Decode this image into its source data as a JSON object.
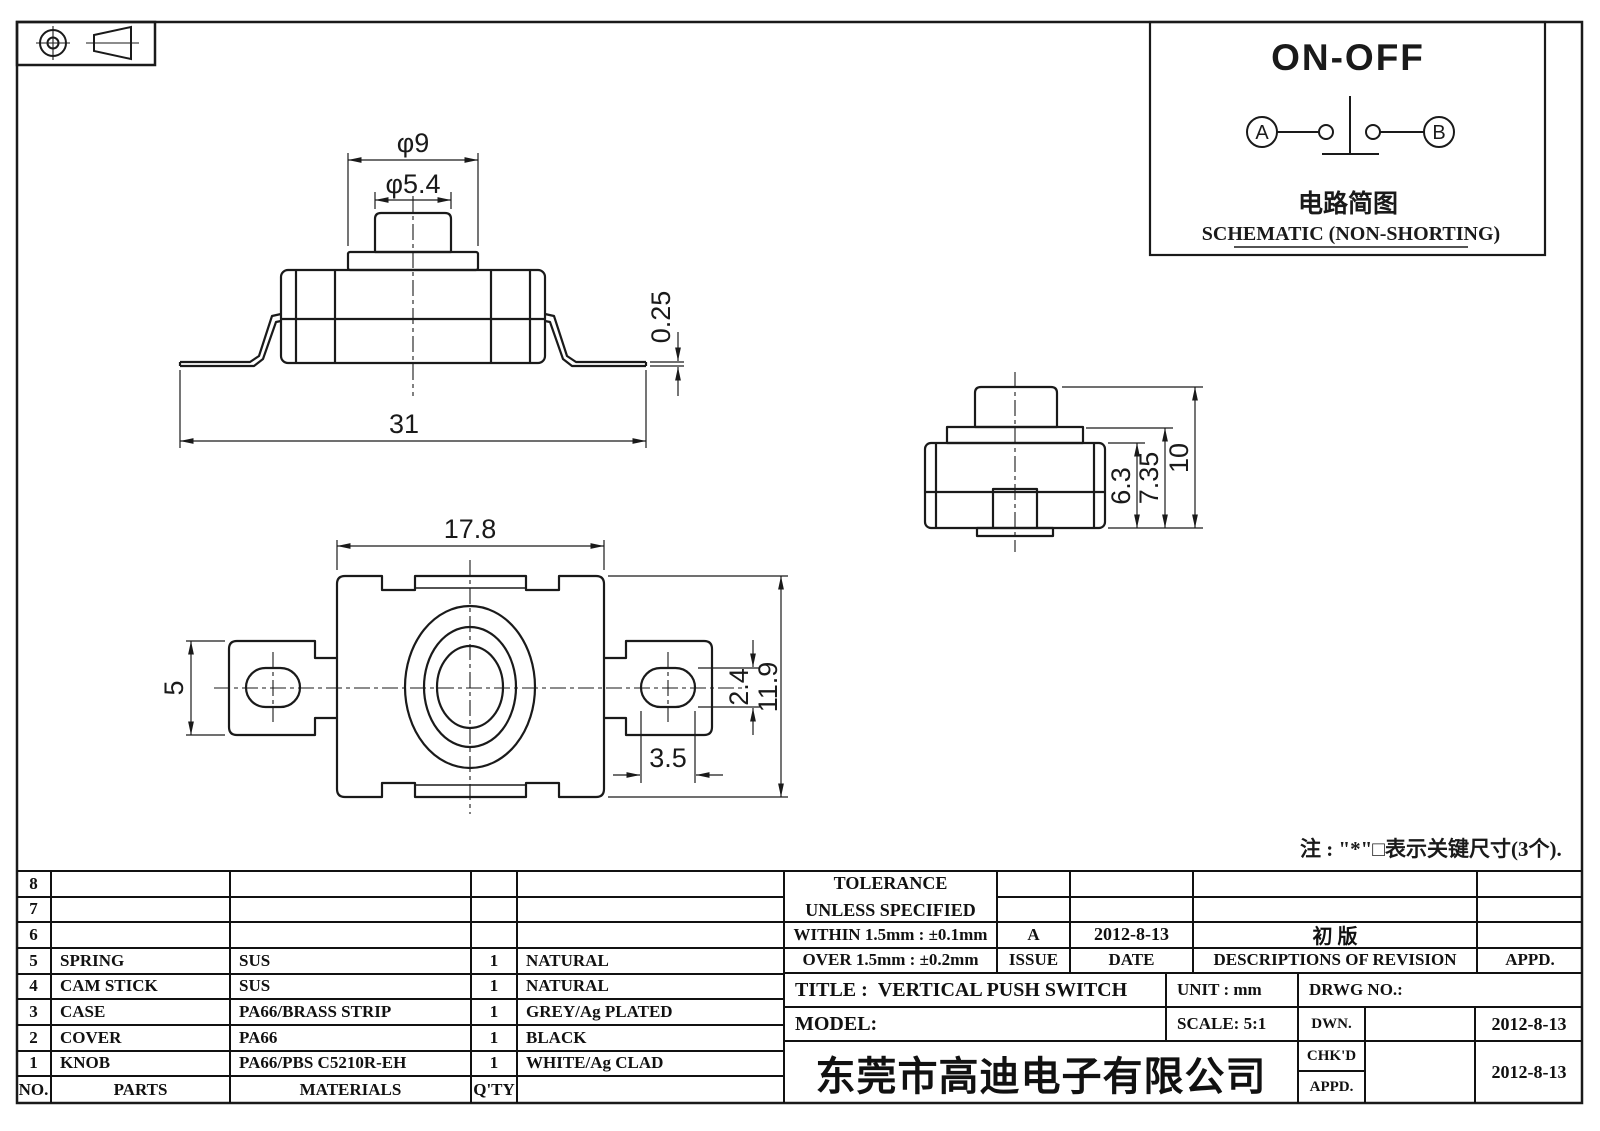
{
  "sheet": {
    "background": "#ffffff",
    "line_color": "#1a1a1a"
  },
  "schematic_panel": {
    "title": "ON-OFF",
    "terminal_a": "A",
    "terminal_b": "B",
    "caption_cn": "电路简图",
    "caption_en": "SCHEMATIC (NON-SHORTING)"
  },
  "note": "注 : \"*\"□表示关键尺寸(3个).",
  "front_view": {
    "dim_flange_dia": "φ9",
    "dim_knob_dia": "φ5.4",
    "dim_lead_thickness": "0.25",
    "dim_total_width": "31"
  },
  "top_view": {
    "dim_body_width": "17.8",
    "dim_tab_width": "5",
    "dim_hole_height": "2.4",
    "dim_hole_width": "3.5",
    "dim_body_height": "11.9"
  },
  "side_view": {
    "dim_case_height": "6.3",
    "dim_with_flange": "7.35",
    "dim_total_height": "10"
  },
  "parts_table": {
    "header": {
      "no": "NO.",
      "parts": "PARTS",
      "materials": "MATERIALS",
      "qty": "Q'TY",
      "finish": ""
    },
    "rows": [
      {
        "no": "8",
        "parts": "",
        "materials": "",
        "qty": "",
        "finish": ""
      },
      {
        "no": "7",
        "parts": "",
        "materials": "",
        "qty": "",
        "finish": ""
      },
      {
        "no": "6",
        "parts": "",
        "materials": "",
        "qty": "",
        "finish": ""
      },
      {
        "no": "5",
        "parts": "SPRING",
        "materials": "SUS",
        "qty": "1",
        "finish": "NATURAL"
      },
      {
        "no": "4",
        "parts": "CAM STICK",
        "materials": "SUS",
        "qty": "1",
        "finish": "NATURAL"
      },
      {
        "no": "3",
        "parts": "CASE",
        "materials": "PA66/BRASS STRIP",
        "qty": "1",
        "finish": "GREY/Ag PLATED"
      },
      {
        "no": "2",
        "parts": "COVER",
        "materials": "PA66",
        "qty": "1",
        "finish": "BLACK"
      },
      {
        "no": "1",
        "parts": "KNOB",
        "materials": "PA66/PBS C5210R-EH",
        "qty": "1",
        "finish": "WHITE/Ag CLAD"
      }
    ]
  },
  "tolerance_block": {
    "title_line1": "TOLERANCE",
    "title_line2": "UNLESS  SPECIFIED",
    "within": "WITHIN 1.5mm : ±0.1mm",
    "over": "OVER 1.5mm : ±0.2mm",
    "issue_value": "A",
    "issue_label": "ISSUE",
    "date_value": "2012-8-13",
    "date_label": "DATE",
    "revision_value": "初  版",
    "revision_label": "DESCRIPTIONS OF REVISION",
    "appd_label": "APPD."
  },
  "title_block": {
    "title_label": "TITLE :",
    "title_value": "VERTICAL PUSH SWITCH",
    "unit": "UNIT :  mm",
    "drwg_no": "DRWG NO.:",
    "model": "MODEL:",
    "scale": "SCALE:  5:1",
    "dwn_label": "DWN.",
    "chkd_label": "CHK'D",
    "appd_label": "APPD.",
    "dwn_date": "2012-8-13",
    "chkd_date": "2012-8-13",
    "company": "东莞市高迪电子有限公司"
  }
}
